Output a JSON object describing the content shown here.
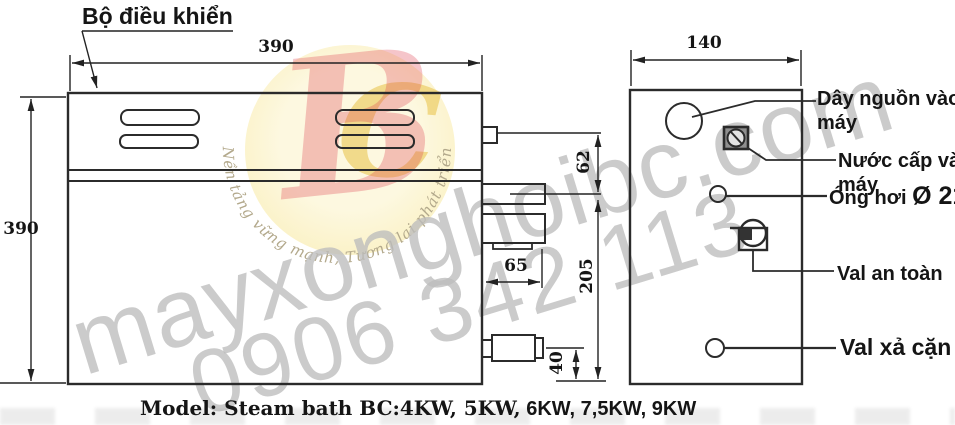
{
  "title": "Bộ điều khiển",
  "dimensions": {
    "front_width": "390",
    "front_height": "390",
    "side_width": "140",
    "upper_offset": "62",
    "lower_span": "205",
    "outlet_width": "65",
    "drain_height": "40"
  },
  "labels": {
    "power": [
      "Dây nguồn vào",
      "máy"
    ],
    "water": [
      "Nước cấp vào",
      "máy"
    ],
    "steam": "Óng hơi",
    "steam_diameter": "Ø 21",
    "safety_valve": "Val an toàn",
    "drain_valve": "Val xả cặn"
  },
  "model_line": {
    "serif_part": "Model: Steam bath BC:4KW, 5KW,",
    "sans_part": " 6KW, 7,5KW, 9KW"
  },
  "watermark": {
    "domain": "mayxonghoibc.com",
    "phone": "0906 342 113",
    "slogan": "Nền tảng vững mạnh, Tương lai phát triển",
    "logo_letter_b": "B",
    "logo_letter_c": "C",
    "logo_circle_color": "#faf0bf",
    "logo_b_color": "#de3e4e",
    "logo_c_color": "#e7c146",
    "text_color": "#bdbdbd"
  },
  "line_color": "#222222"
}
